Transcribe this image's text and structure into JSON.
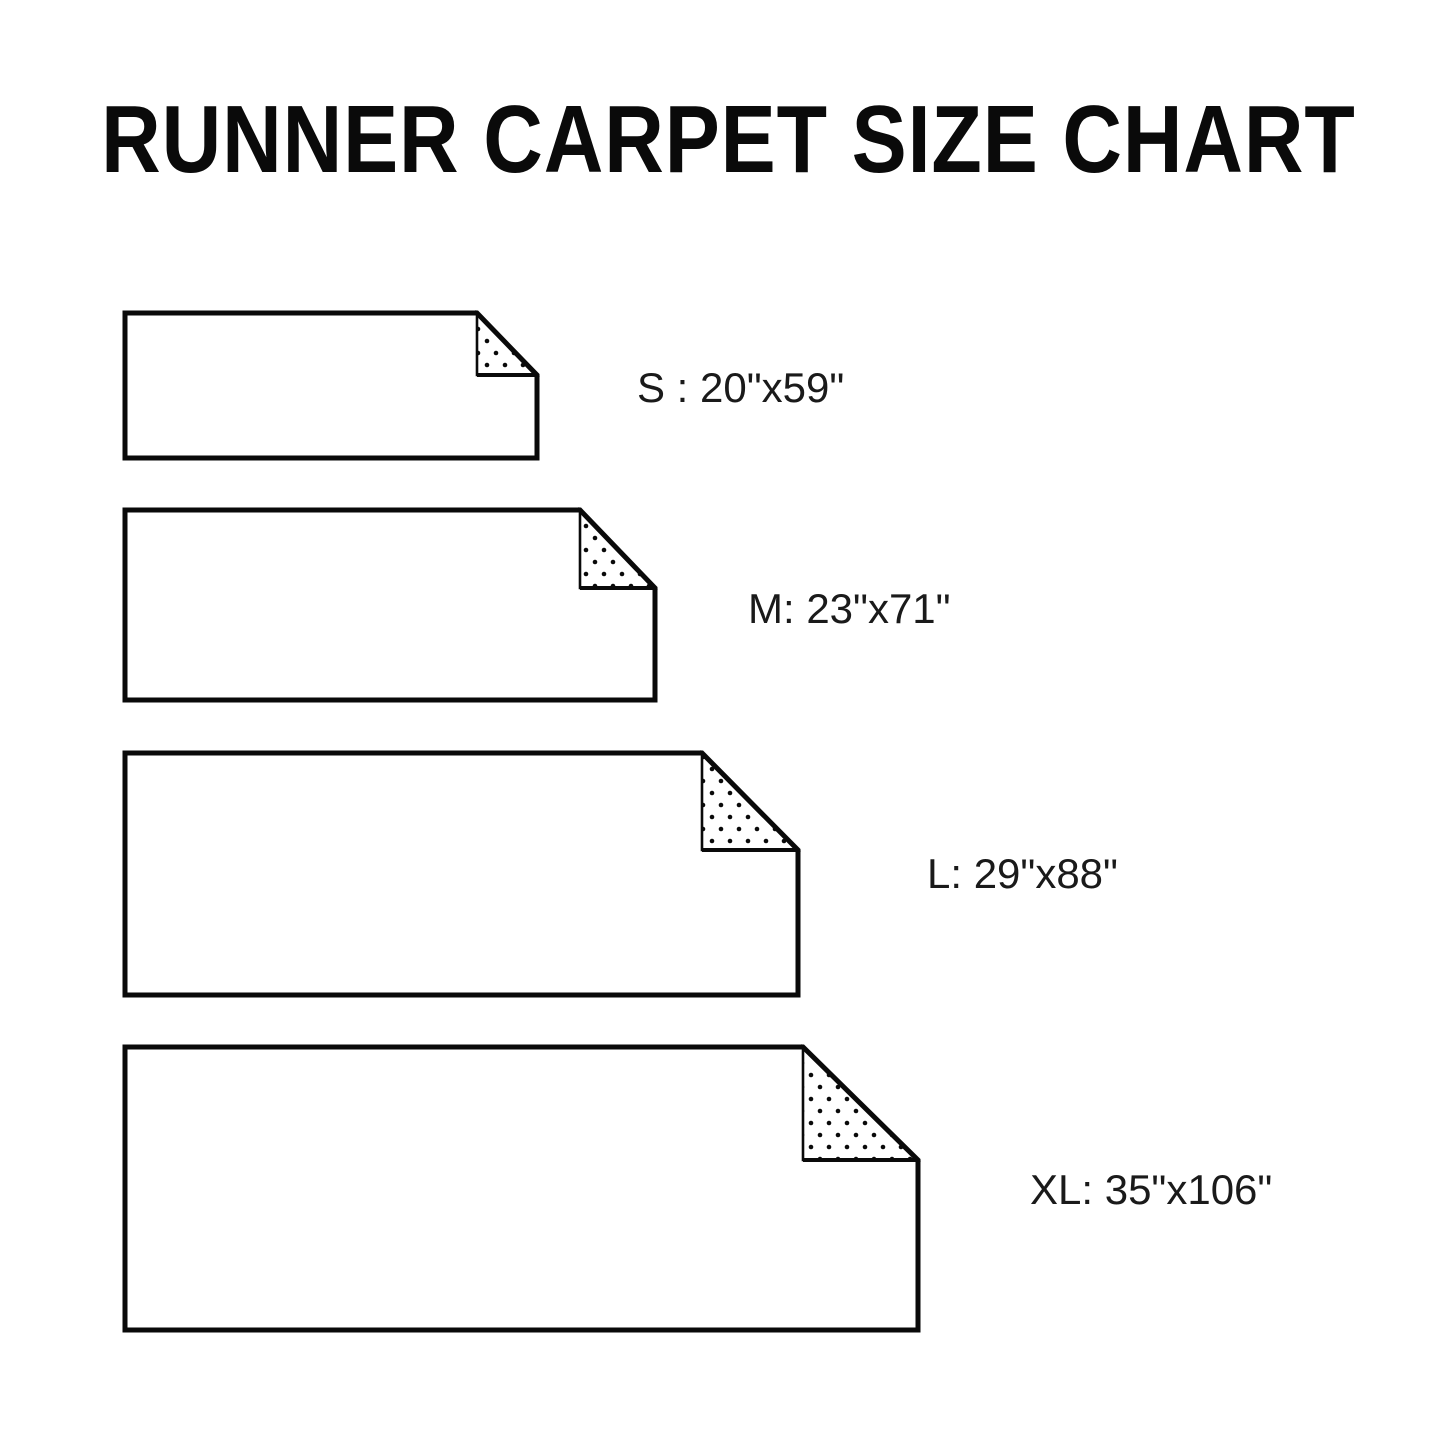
{
  "title": "RUNNER CARPET SIZE CHART",
  "colors": {
    "line": "#0a0a0a",
    "text": "#1a1a1a",
    "background": "#ffffff"
  },
  "sizes": [
    {
      "code": "S",
      "dimensions": "20\"x59\"",
      "label": "S : 20\"x59\""
    },
    {
      "code": "M",
      "dimensions": "23\"x71\"",
      "label": "M: 23\"x71\""
    },
    {
      "code": "L",
      "dimensions": "29\"x88\"",
      "label": "L: 29\"x88\""
    },
    {
      "code": "XL",
      "dimensions": "35\"x106\"",
      "label": "XL: 35\"x106\""
    }
  ],
  "chart_data": {
    "type": "table",
    "title": "RUNNER CARPET SIZE CHART",
    "columns": [
      "size",
      "width_x_length_inches"
    ],
    "rows": [
      [
        "S",
        "20\"x59\""
      ],
      [
        "M",
        "23\"x71\""
      ],
      [
        "L",
        "29\"x88\""
      ],
      [
        "XL",
        "35\"x106\""
      ]
    ]
  }
}
